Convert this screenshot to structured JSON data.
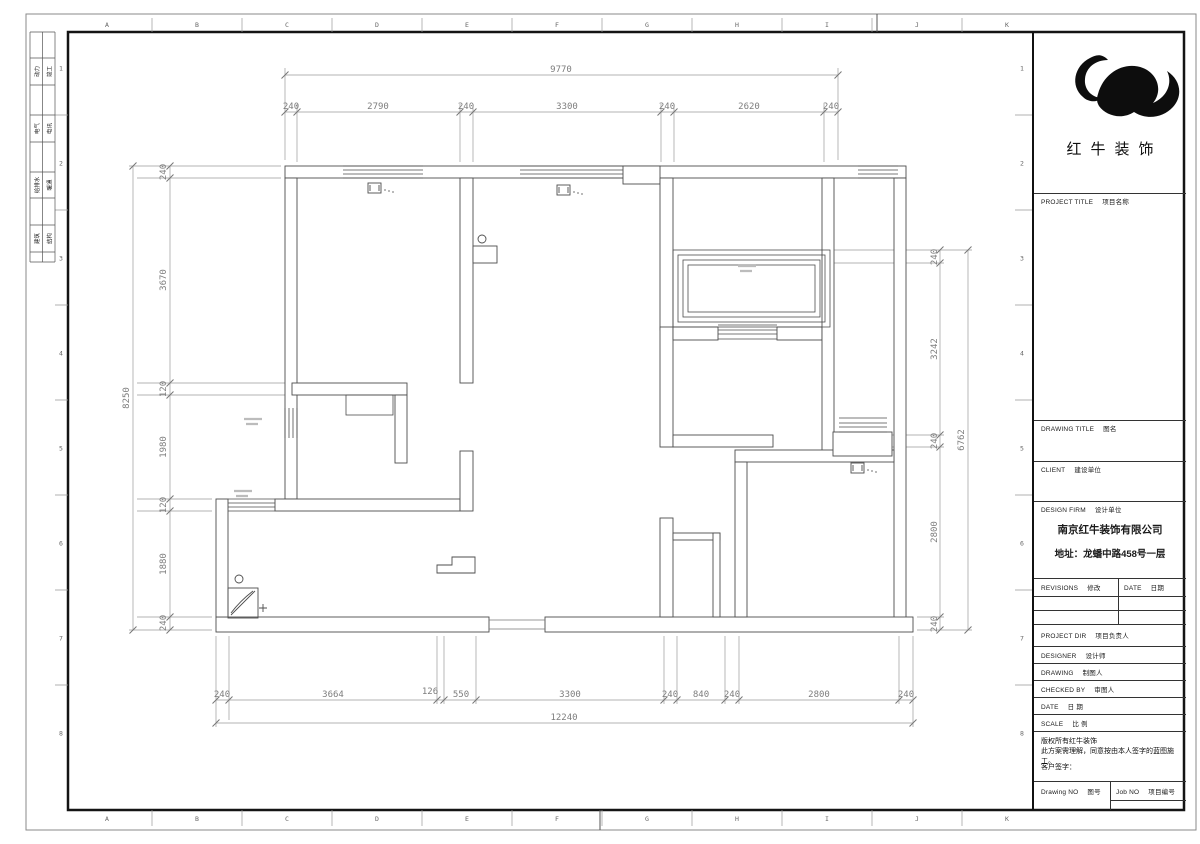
{
  "sheet": {
    "grid_letters": [
      "A",
      "B",
      "C",
      "D",
      "E",
      "F",
      "G",
      "H",
      "I",
      "J",
      "K"
    ],
    "grid_numbers": [
      "1",
      "2",
      "3",
      "4",
      "5",
      "6",
      "7",
      "8"
    ],
    "signoff_rows": [
      {
        "left": "动力",
        "right": "竣工"
      },
      {
        "left": "电气",
        "right": "电讯"
      },
      {
        "left": "给排水",
        "right": "暖通"
      },
      {
        "left": "建筑",
        "right": "结构"
      }
    ]
  },
  "title_block": {
    "brand": "红牛装饰",
    "project_title_en": "PROJECT TITLE",
    "project_title_zh": "项目名称",
    "drawing_title_en": "DRAWING TITLE",
    "drawing_title_zh": "图名",
    "client_en": "CLIENT",
    "client_zh": "建设单位",
    "design_firm_en": "DESIGN FIRM",
    "design_firm_zh": "设计单位",
    "firm_name": "南京红牛装饰有限公司",
    "firm_address": "地址：龙蟠中路458号一层",
    "revisions_en": "REVISIONS",
    "revisions_zh": "修改",
    "date_col_en": "DATE",
    "date_col_zh": "日期",
    "project_dir_en": "PROJECT DIR",
    "project_dir_zh": "项目负责人",
    "designer_en": "DESIGNER",
    "designer_zh": "设计师",
    "drawing_by_en": "DRAWING",
    "drawing_by_zh": "制图人",
    "checked_by_en": "CHECKED BY",
    "checked_by_zh": "审图人",
    "date_row_en": "DATE",
    "date_row_zh": "日 期",
    "scale_en": "SCALE",
    "scale_zh": "比 例",
    "note_line1": "版权所有红牛装饰",
    "note_line2": "此方案需理解，同意按由本人签字的蓝图施工。",
    "note_line3": "客户签字：",
    "drawing_no_en": "Drawing NO",
    "drawing_no_zh": "图号",
    "job_no_en": "Job NO",
    "job_no_zh": "项目编号"
  },
  "dimensions": {
    "top": {
      "overall": "9770",
      "segments": [
        "240",
        "2790",
        "240",
        "3300",
        "240",
        "2620",
        "240"
      ]
    },
    "bottom": {
      "overall": "12240",
      "segments": [
        "240",
        "3664",
        "126",
        "550",
        "3300",
        "240",
        "840",
        "240",
        "2800",
        "240"
      ]
    },
    "left": {
      "overall": "8250",
      "segments": [
        "240",
        "3670",
        "120",
        "1980",
        "120",
        "1880",
        "240"
      ]
    },
    "right": {
      "overall": "6762",
      "segments": [
        "240",
        "3242",
        "240",
        "2800",
        "240"
      ]
    }
  }
}
